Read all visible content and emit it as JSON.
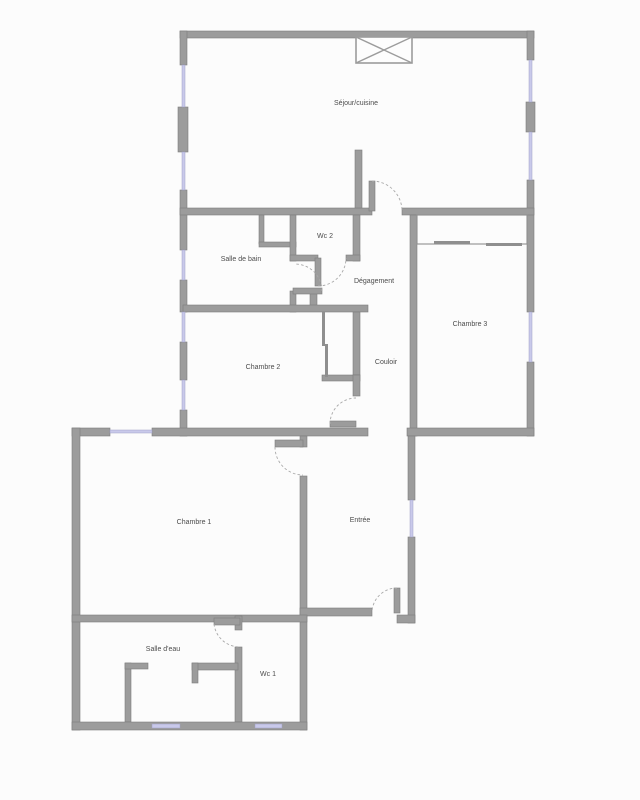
{
  "plan": {
    "type": "apartment-floor-plan",
    "colors": {
      "wall": "#9c9c9c",
      "wallBorder": "#7d7d7d",
      "window": "#c9c9ea",
      "windowBorder": "#9fa0c6",
      "arc": "#a9a9a9",
      "thin": "#8f8f8f",
      "label": "#4c4c4c",
      "bg": "#fcfcfc"
    },
    "rooms": [
      {
        "id": "sejour-cuisine",
        "label": "Séjour/cuisine",
        "x": 356,
        "y": 105
      },
      {
        "id": "wc-2",
        "label": "Wc 2",
        "x": 325,
        "y": 238
      },
      {
        "id": "salle-de-bain",
        "label": "Salle de bain",
        "x": 241,
        "y": 261
      },
      {
        "id": "degagement",
        "label": "Dégagement",
        "x": 374,
        "y": 283
      },
      {
        "id": "chambre-3",
        "label": "Chambre 3",
        "x": 470,
        "y": 326
      },
      {
        "id": "chambre-2",
        "label": "Chambre 2",
        "x": 263,
        "y": 369
      },
      {
        "id": "couloir",
        "label": "Couloir",
        "x": 386,
        "y": 364
      },
      {
        "id": "chambre-1",
        "label": "Chambre 1",
        "x": 194,
        "y": 524
      },
      {
        "id": "entree",
        "label": "Entrée",
        "x": 360,
        "y": 522
      },
      {
        "id": "salle-d-eau",
        "label": "Salle d'eau",
        "x": 163,
        "y": 651
      },
      {
        "id": "wc-1",
        "label": "Wc 1",
        "x": 268,
        "y": 676
      }
    ]
  }
}
